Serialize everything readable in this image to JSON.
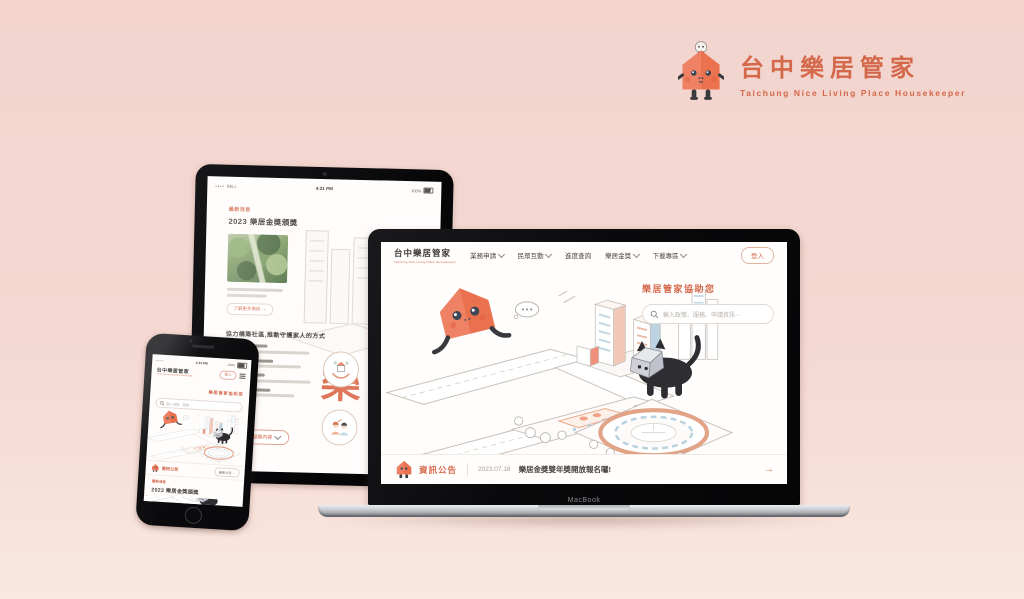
{
  "brand": {
    "name": "台中樂居管家",
    "tagline": "Taichung Nice Living Place Housekeeper",
    "accent_color": "#d4684a"
  },
  "laptop": {
    "model_label": "MacBook",
    "site_logo": {
      "title": "台中樂居管家",
      "subtitle": "Taichung Nice Living Place Housekeeper"
    },
    "nav": [
      {
        "label": "業務申請"
      },
      {
        "label": "民眾互動"
      },
      {
        "label": "進度查詢"
      },
      {
        "label": "樂居金獎"
      },
      {
        "label": "下載專區"
      }
    ],
    "login_label": "登入",
    "assist": {
      "title": "樂居管家協助您",
      "search_placeholder": "輸入政策、服務、申請資訊⋯"
    },
    "announcement": {
      "label": "資訊公告",
      "date": "2023.07.18",
      "headline": "樂居金獎雙年獎開放報名囉!",
      "arrow": "→"
    }
  },
  "tablet": {
    "status": {
      "carrier": "BELL",
      "time": "4:21 PM",
      "battery": "100%"
    },
    "article": {
      "tag": "最新消息",
      "title": "2023 樂居金獎頒獎",
      "more_label": "了解更多資訊 →"
    },
    "section": {
      "heading": "協力構築社區,推動守護家人的方式",
      "cta_label": "查看更多服務內容"
    },
    "watermark_glyph": "樂"
  },
  "phone": {
    "status": {
      "time": "4:21 PM",
      "battery": "100%"
    },
    "logo_title": "台中樂居管家",
    "logo_subtitle": "Taichung Nice Living Place Housekeeper",
    "login_label": "登入",
    "assist": {
      "title": "樂居管家協助您",
      "search_placeholder": "輸入政策、服務⋯"
    },
    "announcement": {
      "label": "資訊公告",
      "link_label": "最新公告 →"
    },
    "article": {
      "tag": "最新消息",
      "title": "2023 樂居金獎頒獎"
    }
  }
}
